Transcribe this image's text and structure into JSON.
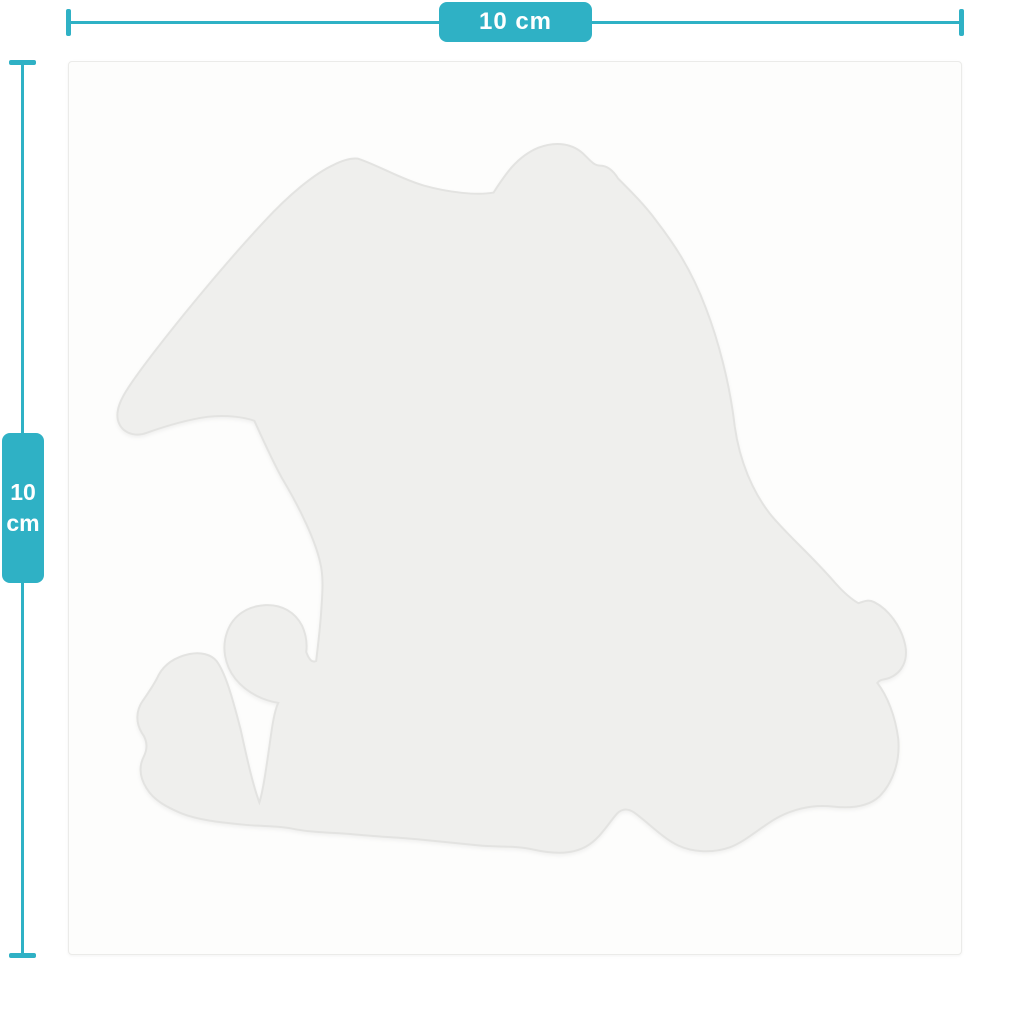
{
  "page": {
    "background_color": "#ffffff",
    "description": "Sticker size mockup diagram, 10 cm by 10 cm"
  },
  "rulers": {
    "accent_color": "#2fb1c5",
    "horizontal": {
      "label": "10 cm"
    },
    "vertical": {
      "value": "10",
      "unit": "cm"
    }
  },
  "canvas": {
    "background_color": "#fdfdfc",
    "sticker_fill": "#efefed",
    "sticker_stroke": "#e3e3e1"
  }
}
